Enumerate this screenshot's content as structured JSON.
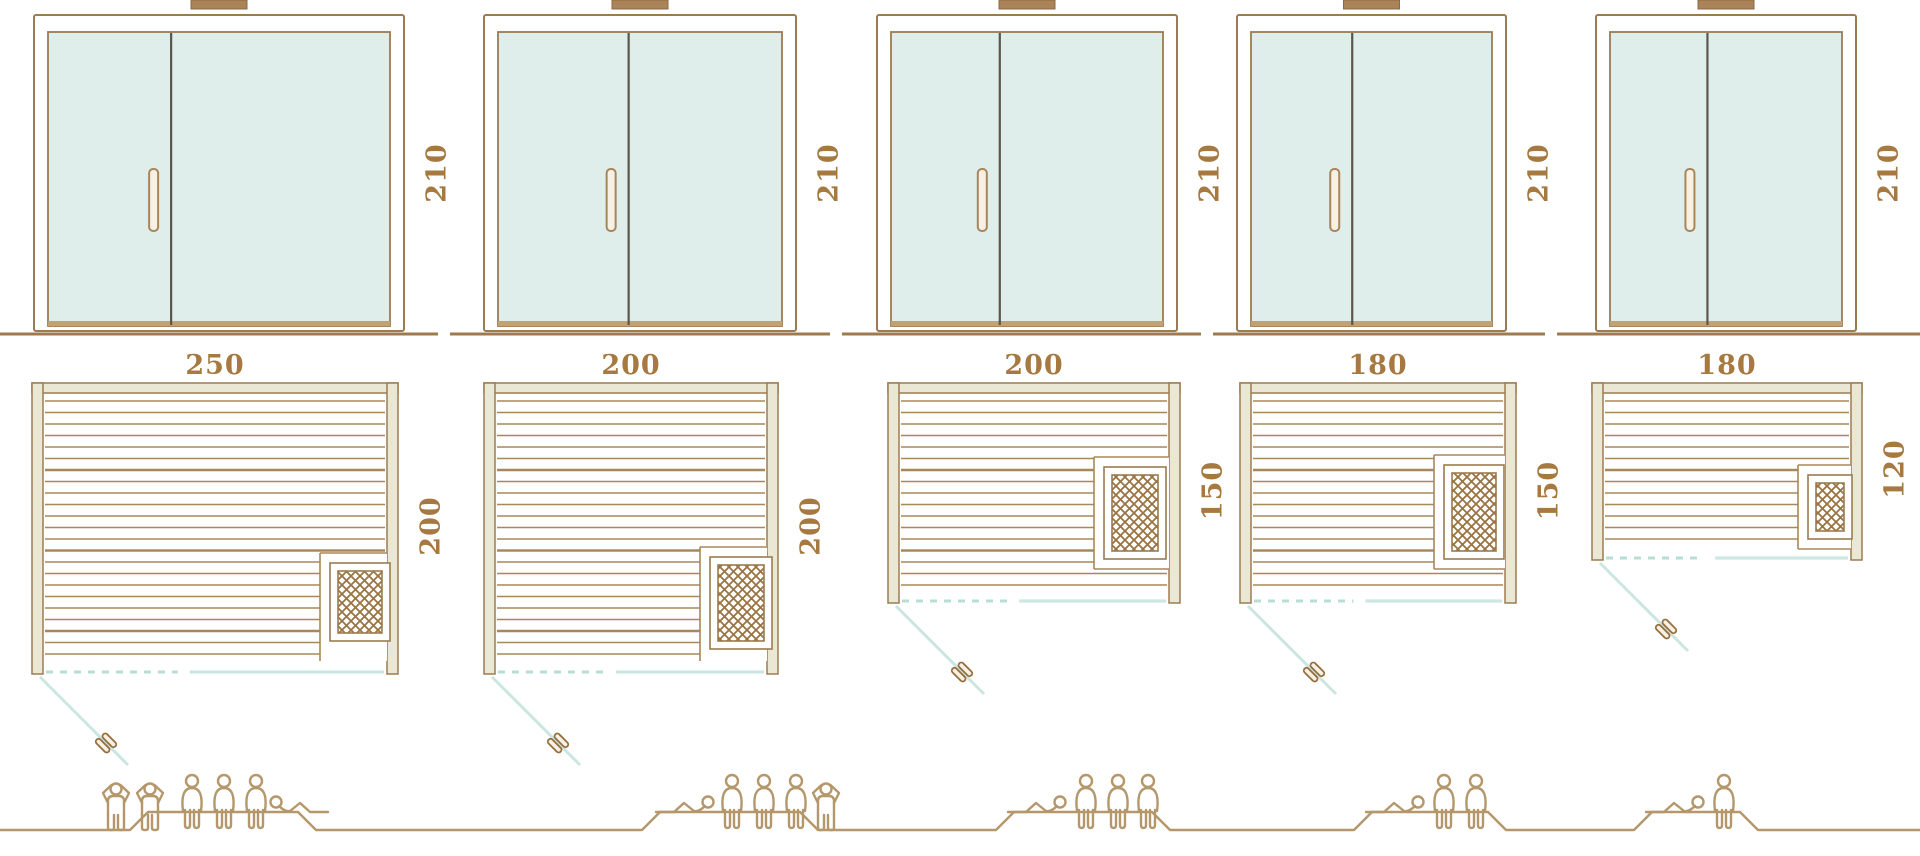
{
  "diagram": {
    "kind": "sauna-size-comparison",
    "door_height_unit_values_visible": [
      "210",
      "210",
      "210",
      "210",
      "210"
    ]
  },
  "saunas": [
    {
      "id": "sauna-250x200",
      "door_height": "210",
      "width": "250",
      "depth": "200",
      "capacity": 6,
      "people": [
        "standing",
        "standing",
        "sitting",
        "sitting",
        "sitting",
        "lying"
      ]
    },
    {
      "id": "sauna-200x200",
      "door_height": "210",
      "width": "200",
      "depth": "200",
      "capacity": 5,
      "people": [
        "lying",
        "sitting",
        "sitting",
        "sitting",
        "standing"
      ]
    },
    {
      "id": "sauna-200x150",
      "door_height": "210",
      "width": "200",
      "depth": "150",
      "capacity": 4,
      "people": [
        "lying",
        "sitting",
        "sitting",
        "sitting"
      ]
    },
    {
      "id": "sauna-180x150",
      "door_height": "210",
      "width": "180",
      "depth": "150",
      "capacity": 3,
      "people": [
        "lying",
        "sitting",
        "sitting"
      ]
    },
    {
      "id": "sauna-180x120",
      "door_height": "210",
      "width": "180",
      "depth": "120",
      "capacity": 2,
      "people": [
        "lying",
        "sitting"
      ]
    }
  ],
  "icons": {
    "heater": "heater-crosshatch-icon",
    "door_swing": "door-swing-line",
    "plan_handle": "door-handle-icon",
    "capacity": "capacity-person-icons"
  },
  "colors": {
    "outline": "#9c7b50",
    "wood_fill": "#eae7d5",
    "glass": "#dfeeea",
    "divider": "#5b564b",
    "slat": "#a8875a",
    "hatch": "#9a7442",
    "label": "#a5793f",
    "mint_dash": "#b7ddd7",
    "mint_solid": "#cde7e2",
    "swing": "#cbe6e1",
    "people": "#b4976a",
    "vent": "#aa8458",
    "threshold": "#c2a173",
    "handle_fill": "#f6f0e5",
    "handle_stroke": "#a9855a"
  }
}
